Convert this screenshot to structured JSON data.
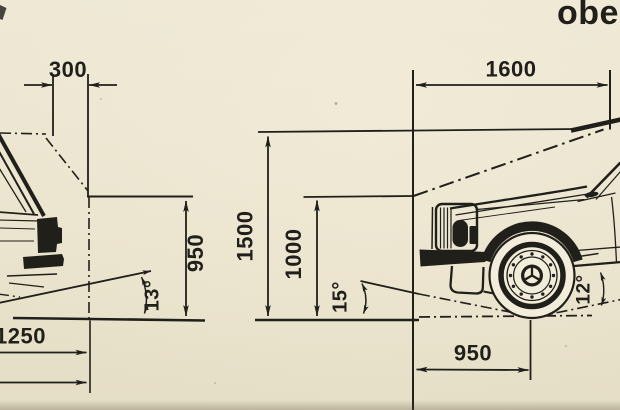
{
  "page": {
    "corner_label": "obe",
    "paper_color": "#eae3cd",
    "ink_color": "#211f1a"
  },
  "left_drawing": {
    "dim_top_width": "300",
    "dim_height": "950",
    "angle_departure": "13°",
    "dim_overhang": "1250"
  },
  "right_drawing": {
    "dim_top_width": "1600",
    "dim_height_total": "1500",
    "dim_height_hood": "1000",
    "angle_approach": "15°",
    "angle_sill": "12°",
    "dim_front": "950"
  }
}
